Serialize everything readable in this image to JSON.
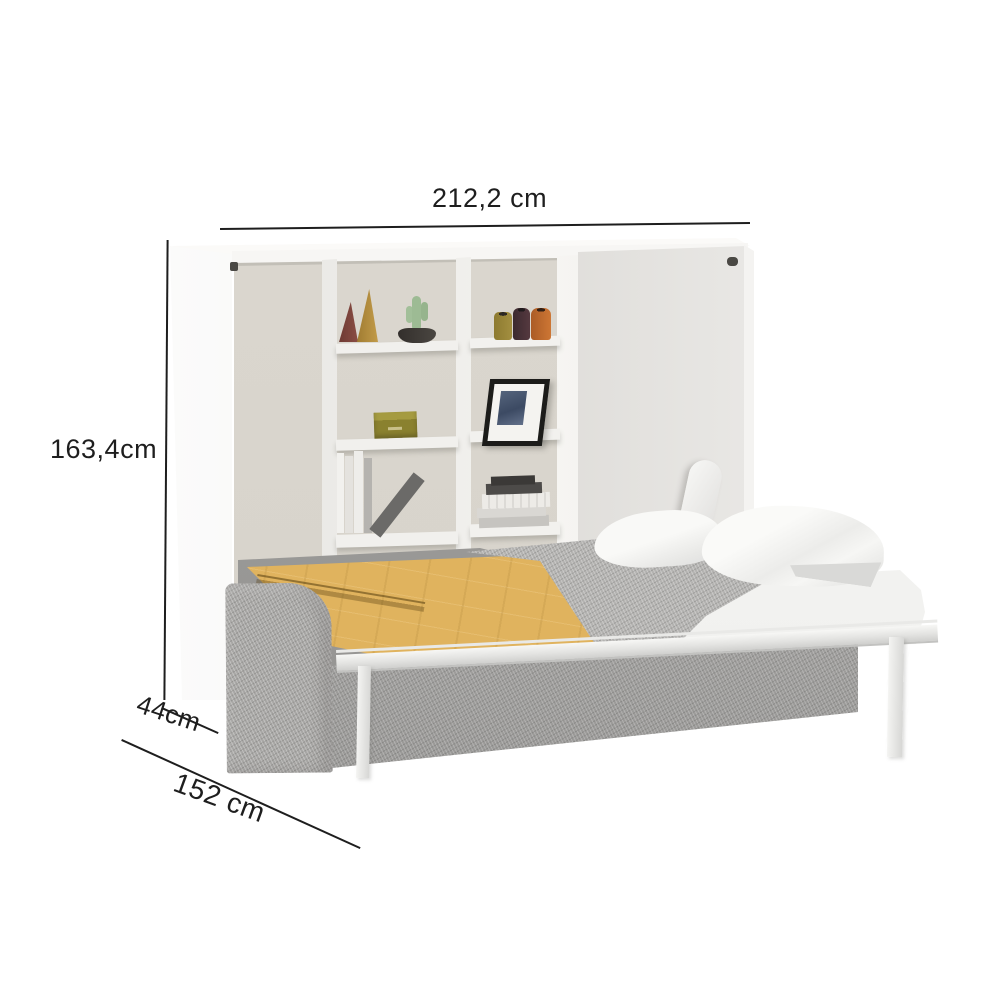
{
  "annotations": {
    "width_label": "212,2 cm",
    "height_label": "163,4cm",
    "depth_label": "44cm",
    "extension_label": "152 cm"
  },
  "scene": {
    "type": "horizontal wall bed with bookshelf, shown open",
    "colors": {
      "background": "#ffffff",
      "cabinet_white": "#f6f5f3",
      "interior_back": "#d7d3cb",
      "open_flap": "#d3d0cc",
      "sofa_fabric_grey": "#a9a8a6",
      "mattress_grey": "#9e9d9b",
      "blanket_yellow": "#e0b35e",
      "blanket_grey": "#b4b3b1",
      "bedding_white": "#f8f8f6",
      "metal_frame_white": "#f2f2f0",
      "dimension_ink": "#1e1e1e"
    },
    "decor": [
      "red cone vase",
      "mustard cone vase",
      "cactus in black pot",
      "olive jar",
      "dark brown jar",
      "orange jar",
      "olive storage box",
      "black picture frame",
      "white books",
      "leaning grey book",
      "stacked books"
    ]
  }
}
